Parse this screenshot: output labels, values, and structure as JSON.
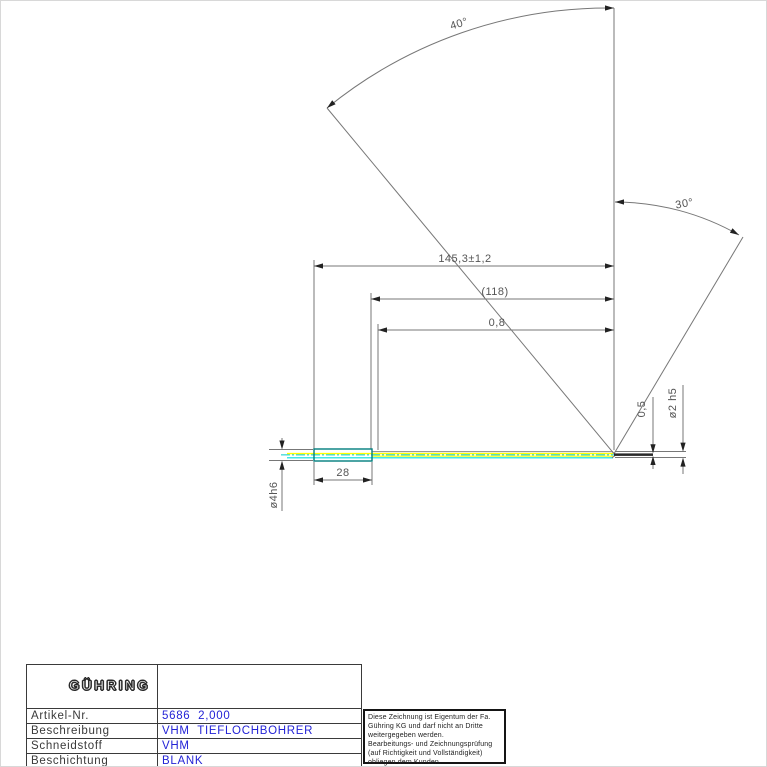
{
  "drawing": {
    "angle_labels": {
      "top": "40°",
      "right": "30°"
    },
    "dimensions": {
      "overall_length": "145,3±1,2",
      "flute_length": "(118)",
      "step_length": "0,8",
      "shank_length": "28",
      "shank_diameter": "ø4h6",
      "core_diameter": "0,5",
      "cutting_diameter": "ø2 h5"
    },
    "colors": {
      "shank_outline": "#007d7d",
      "coolant_line": "#ffff00",
      "centerline": "#00cccc",
      "drawing_line": "#777777",
      "value_text": "#2323d6"
    }
  },
  "titleblock": {
    "logo": "GÜHRING",
    "rows": [
      {
        "label": "Artikel-Nr.",
        "value": "5686  2,000"
      },
      {
        "label": "Beschreibung",
        "value": "VHM  TIEFLOCHBOHRER"
      },
      {
        "label": "Schneidstoff",
        "value": "VHM"
      },
      {
        "label": "Beschichtung",
        "value": "BLANK"
      },
      {
        "label": "Kuehlung",
        "value": "Innenkuehlung  /  MMS"
      },
      {
        "label": "Schneiden",
        "value": "1"
      }
    ]
  },
  "disclaimer": "Diese Zeichnung ist Eigentum der Fa.\nGühring KG und darf nicht an Dritte\nweitergegeben werden.\nBearbeitungs- und Zeichnungsprüfung\n(auf Richtigkeit und Vollständigkeit)\nobliegen dem Kunden."
}
